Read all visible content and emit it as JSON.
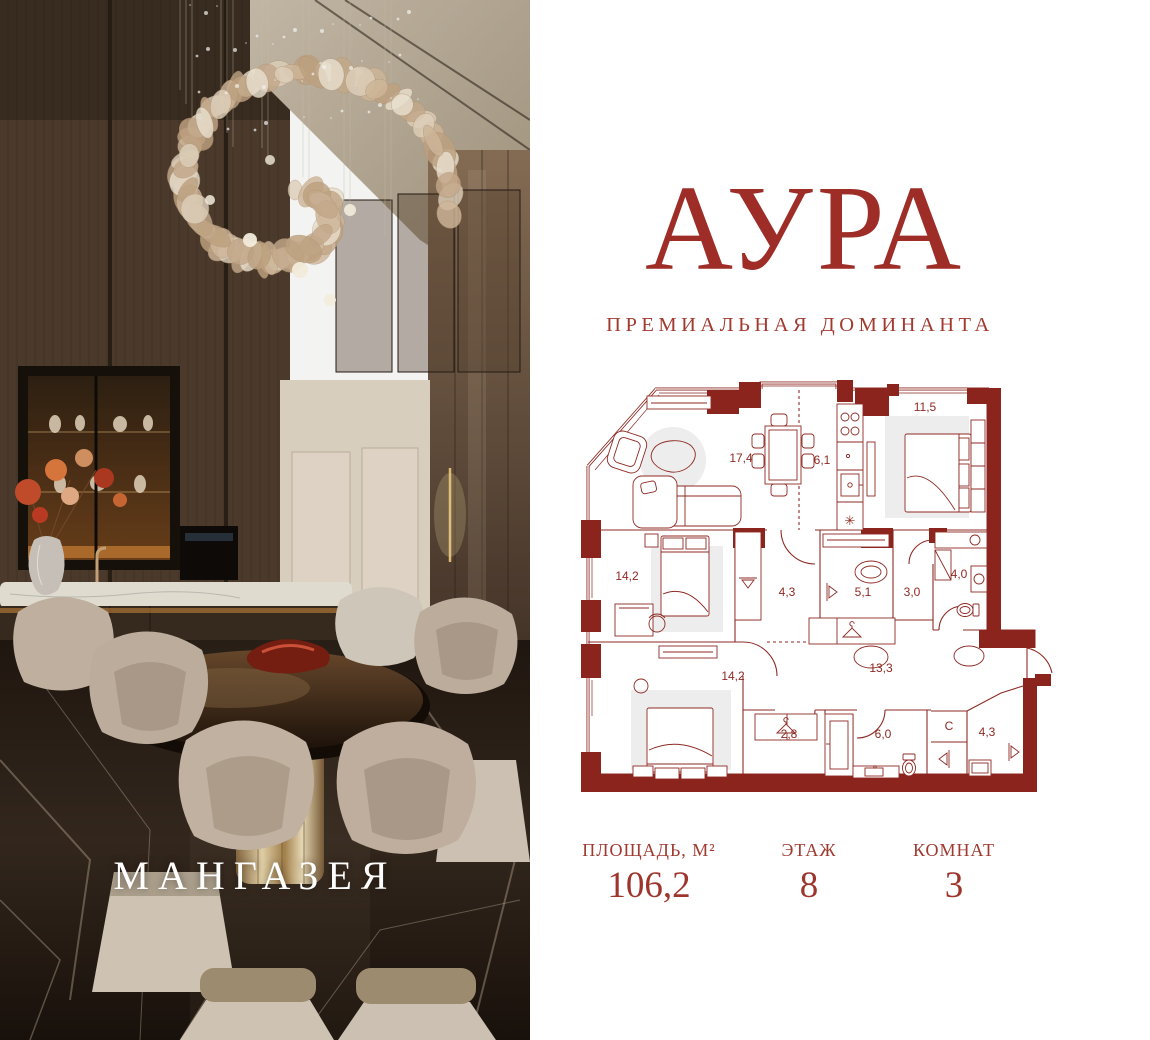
{
  "brand": {
    "project_name": "АУРА",
    "tagline": "ПРЕМИАЛЬНАЯ ДОМИНАНТА",
    "developer_name": "МАНГАЗЕЯ"
  },
  "colors": {
    "accent_red": "#9E2D27",
    "plan_line": "#8E2A23",
    "plan_wall_fill": "#8C241E",
    "plan_pad": "#EDEDED",
    "background": "#FFFFFF",
    "photo_text": "#FFFFFF"
  },
  "floor_plan": {
    "room_labels": [
      {
        "t": "17,4",
        "x": 166,
        "y": 82
      },
      {
        "t": "6,1",
        "x": 247,
        "y": 84
      },
      {
        "t": "11,5",
        "x": 350,
        "y": 31
      },
      {
        "t": "14,2",
        "x": 52,
        "y": 200
      },
      {
        "t": "4,3",
        "x": 212,
        "y": 216
      },
      {
        "t": "5,1",
        "x": 288,
        "y": 216
      },
      {
        "t": "3,0",
        "x": 337,
        "y": 216
      },
      {
        "t": "4,0",
        "x": 384,
        "y": 198
      },
      {
        "t": "14,2",
        "x": 158,
        "y": 300
      },
      {
        "t": "13,3",
        "x": 306,
        "y": 292
      },
      {
        "t": "2,8",
        "x": 214,
        "y": 358
      },
      {
        "t": "6,0",
        "x": 308,
        "y": 358
      },
      {
        "t": "С",
        "x": 374,
        "y": 350
      },
      {
        "t": "4,3",
        "x": 412,
        "y": 356
      }
    ],
    "fridge_symbol": "✳"
  },
  "stats": {
    "items": [
      {
        "label": "ПЛОЩАДЬ, М²",
        "value": "106,2"
      },
      {
        "label": "ЭТАЖ",
        "value": "8"
      },
      {
        "label": "КОМНАТ",
        "value": "3"
      }
    ]
  }
}
